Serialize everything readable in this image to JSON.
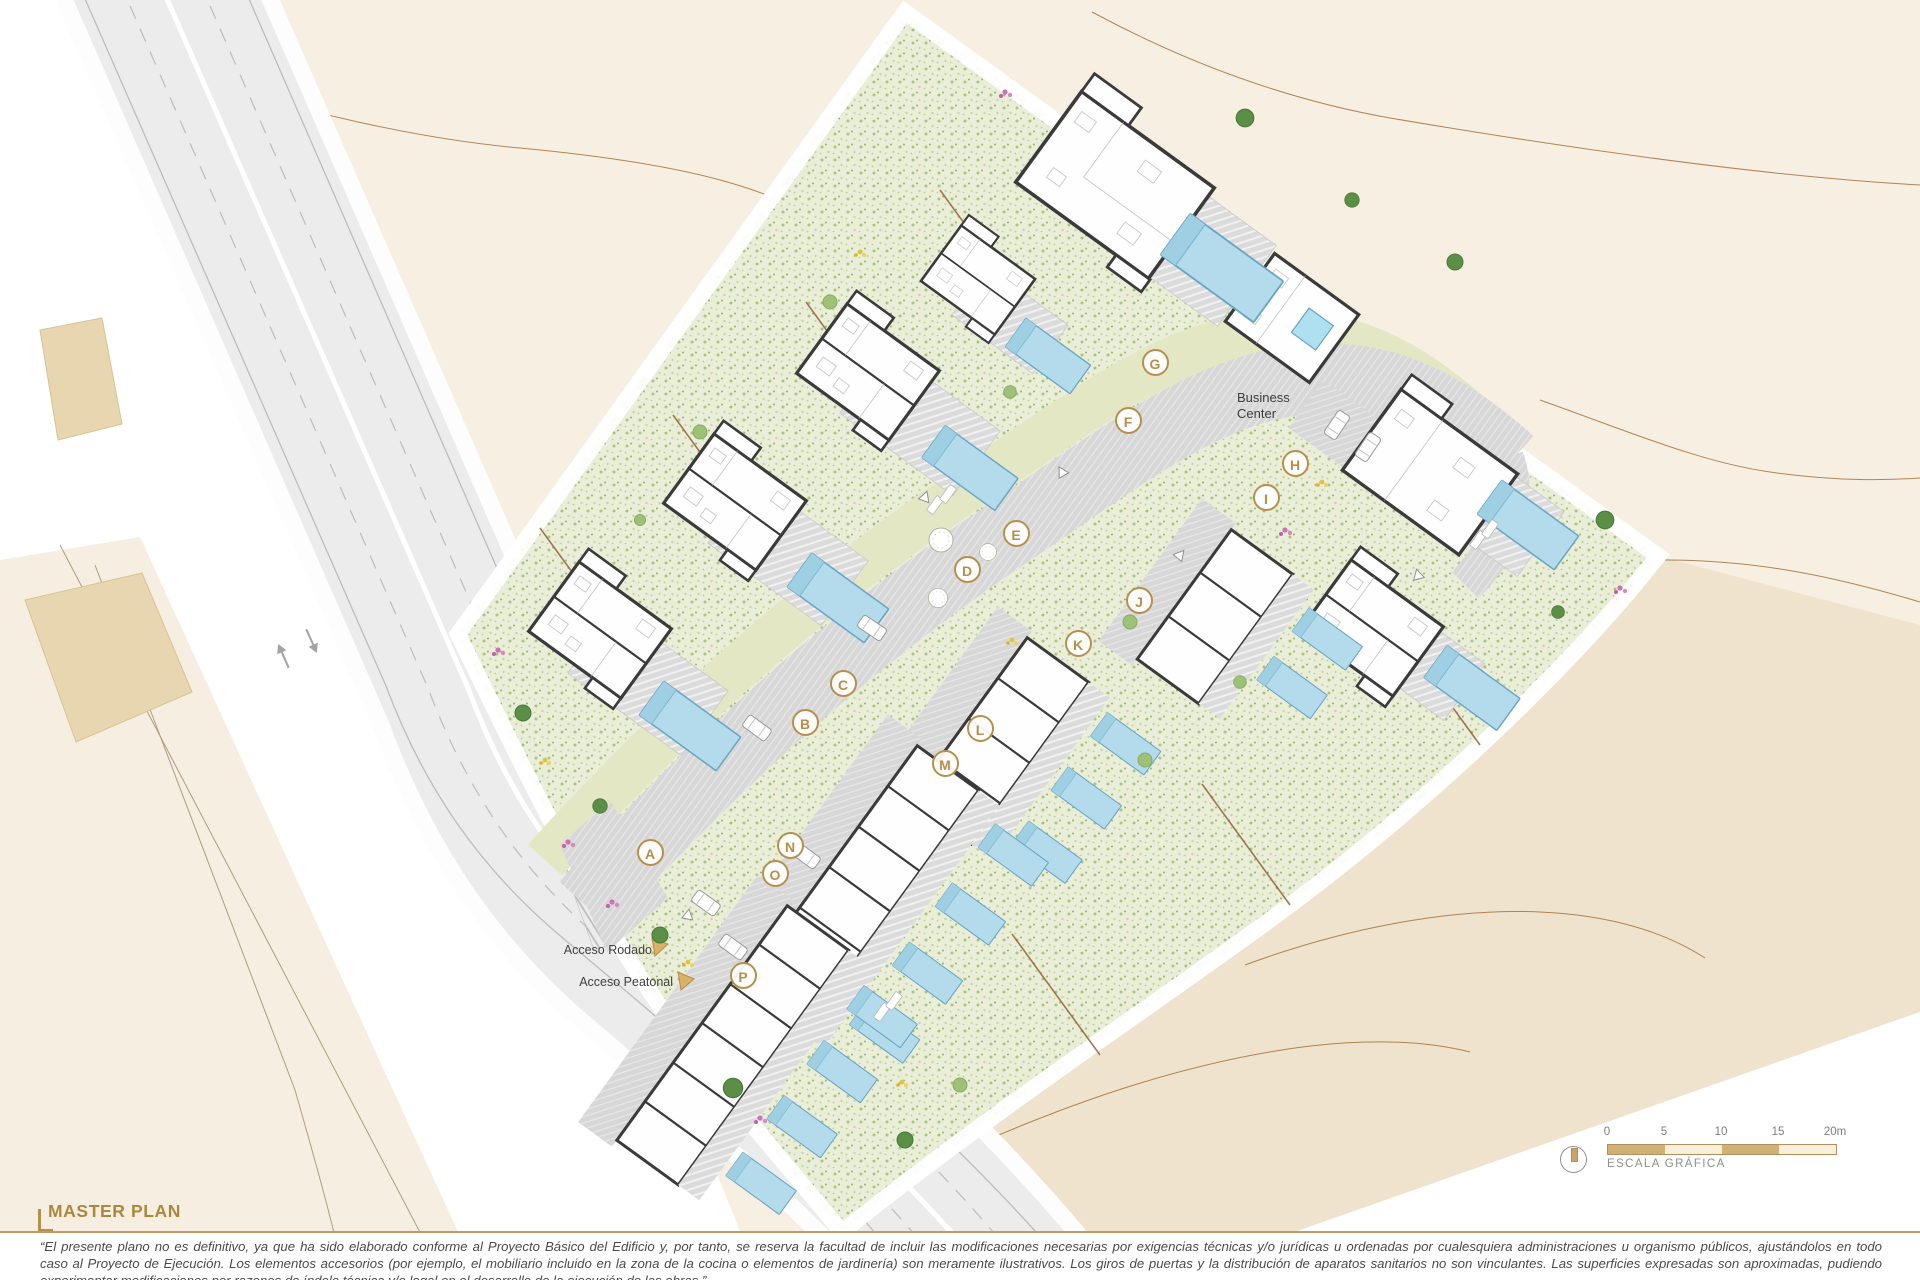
{
  "title_block": {
    "title": "MASTER PLAN"
  },
  "plan_labels": {
    "business_center": "Business Center",
    "access_road": "Acceso Rodado",
    "access_pedestrian": "Acceso Peatonal"
  },
  "unit_markers": [
    {
      "letter": "A",
      "x": 650,
      "y": 852
    },
    {
      "letter": "B",
      "x": 805,
      "y": 722
    },
    {
      "letter": "C",
      "x": 843,
      "y": 683
    },
    {
      "letter": "D",
      "x": 967,
      "y": 569
    },
    {
      "letter": "E",
      "x": 1016,
      "y": 533
    },
    {
      "letter": "F",
      "x": 1128,
      "y": 420
    },
    {
      "letter": "G",
      "x": 1155,
      "y": 362
    },
    {
      "letter": "H",
      "x": 1295,
      "y": 463
    },
    {
      "letter": "I",
      "x": 1266,
      "y": 497
    },
    {
      "letter": "J",
      "x": 1139,
      "y": 600
    },
    {
      "letter": "K",
      "x": 1078,
      "y": 643
    },
    {
      "letter": "L",
      "x": 980,
      "y": 728
    },
    {
      "letter": "M",
      "x": 945,
      "y": 763
    },
    {
      "letter": "N",
      "x": 790,
      "y": 845
    },
    {
      "letter": "O",
      "x": 775,
      "y": 873
    },
    {
      "letter": "P",
      "x": 743,
      "y": 975
    }
  ],
  "scale_bar": {
    "tick_labels": [
      "0",
      "5",
      "10",
      "15",
      "20m"
    ],
    "caption": "ESCALA GRÁFICA",
    "segment_colors": [
      "#d2b073",
      "#f7efd9",
      "#d2b073",
      "#f7efd9"
    ],
    "north_icon": "compass-circle-icon"
  },
  "disclaimer": {
    "lines": [
      "“El presente plano no es definitivo, ya que ha sido elaborado conforme al Proyecto Básico del Edificio y, por tanto, se reserva la facultad de incluir las modificaciones necesarias por exigencias técnicas y/o jurídicas u ordenadas por cualesquiera administraciones u organismo públicos, ajustándolos en todo",
      "caso al Proyecto de Ejecución. Los elementos accesorios (por ejemplo, el mobiliario incluido en la zona de la cocina o elementos de jardinería) son meramente ilustrativos. Los giros de puertas y la distribución de aparatos sanitarios no son vinculantes. Las superficies expresadas son aproximadas, pudiendo",
      "experimentar modificaciones por razones de índole técnica y/o legal en el desarrollo de la ejecución de las obras.”"
    ]
  },
  "colors": {
    "accent_gold": "#b68f4c",
    "title_gold": "#ab883e",
    "terrain_cream": "#f7efe2",
    "terrain_tan": "#f0e3cd",
    "garden_green": "#eaeed9",
    "hedge_green": "#679a4e",
    "pool_blue": "#b3dbeb",
    "road_gray": "#ececec",
    "wall_dark": "#3a3a3a"
  }
}
